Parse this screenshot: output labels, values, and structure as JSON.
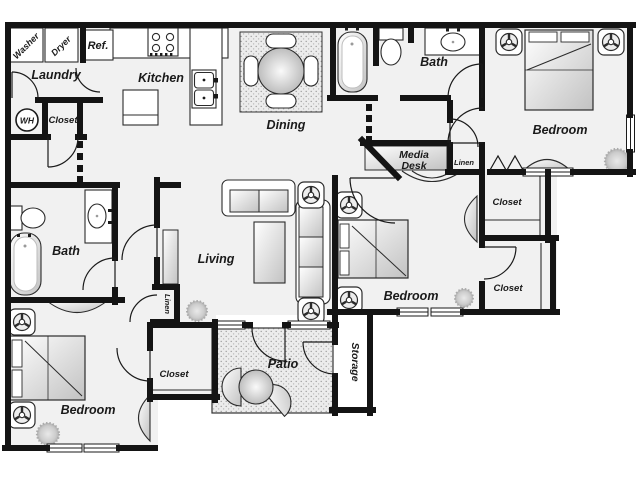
{
  "plan": {
    "labels": {
      "washer": "Washer",
      "dryer": "Dryer",
      "refrigerator": "Ref.",
      "laundry": "Laundry",
      "kitchen": "Kitchen",
      "water_heater": "WH",
      "laundry_closet": "Closet",
      "dining": "Dining",
      "upper_bath": "Bath",
      "upper_bedroom": "Bedroom",
      "media_desk_line1": "Media",
      "media_desk_line2": "Desk",
      "hall_linen": "Linen",
      "upper_right_closet": "Closet",
      "lower_right_closet": "Closet",
      "middle_bedroom": "Bedroom",
      "living": "Living",
      "left_bath": "Bath",
      "left_linen": "Linen",
      "lower_bedroom": "Bedroom",
      "lower_bedroom_closet": "Closet",
      "patio": "Patio",
      "storage": "Storage"
    },
    "colors": {
      "wall": "#141414",
      "floor": "#f1f1f1",
      "text": "#1a1a1a",
      "background": "#ffffff"
    }
  }
}
